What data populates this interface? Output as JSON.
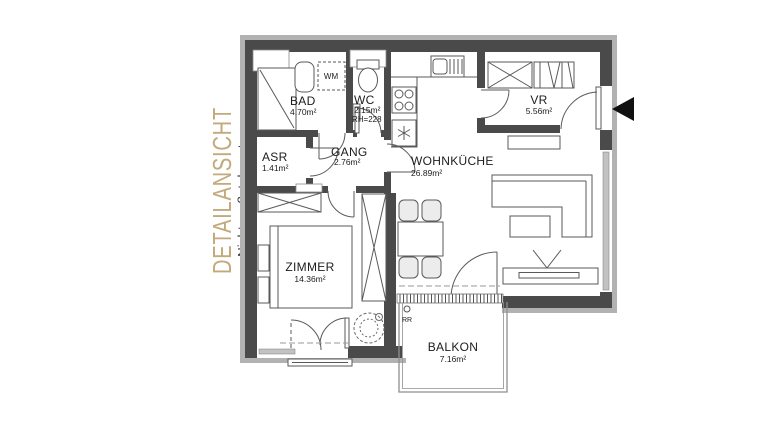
{
  "annotation": {
    "title": "DETAILANSICHT",
    "subtitle": "Nicht maßstabsgetreu"
  },
  "colors": {
    "accent": "#c2aa7c",
    "wall": "#4a4a4a",
    "wall_band": "#b2b2b2",
    "line": "#5a5a5a",
    "text": "#1c1c1c"
  },
  "rooms": {
    "bad": {
      "name": "BAD",
      "area": "4.70m²"
    },
    "wc": {
      "name": "WC",
      "area": "2.15m²",
      "room_height": "RH=228"
    },
    "asr": {
      "name": "ASR",
      "area": "1.41m²"
    },
    "gang": {
      "name": "GANG",
      "area": "2.76m²"
    },
    "vr": {
      "name": "VR",
      "area": "5.56m²"
    },
    "wohnkueche": {
      "name": "WOHNKÜCHE",
      "area": "26.89m²"
    },
    "zimmer": {
      "name": "ZIMMER",
      "area": "14.36m²"
    },
    "balkon": {
      "name": "BALKON",
      "area": "7.16m²"
    }
  },
  "symbols": {
    "washing_machine": "WM",
    "rain_pipe": "RR"
  }
}
